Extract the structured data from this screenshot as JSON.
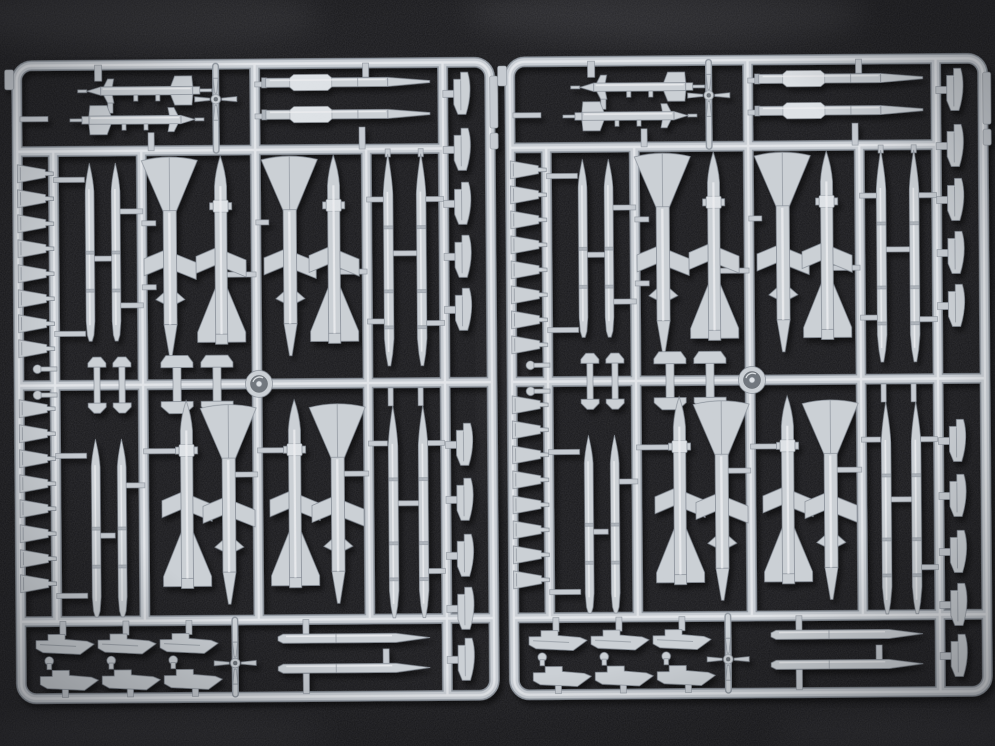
{
  "scene": {
    "description": "Photograph of two identical light-grey injection-moulded plastic model sprues holding air-to-air missile halves, missile bodies, pylons and fin parts, lying side by side on a dark charcoal fabric background",
    "objects": [
      {
        "label": "left parts sprue"
      },
      {
        "label": "right parts sprue, identical duplicate of the left one"
      }
    ],
    "surface": "dark woven fabric",
    "lighting": "soft light from upper left, parts cast small shadows down and right"
  },
  "colors": {
    "background": "#17171a",
    "fabric_highlight": "#8a8a90",
    "plastic_base": "#cbd0d5",
    "plastic_highlight": "#e9ecee",
    "plastic_shadow": "#8f969f",
    "part_outline": "#868d96",
    "ring_inner": "#70767d"
  },
  "sprue_contents_per_sprue": {
    "large_missile_halves_with_butterfly_fins": 8,
    "slim_missile_halves_vertical": 8,
    "canard_missiles_horizontal": 2,
    "missile_bodies_with_dorsal_fairing": 2,
    "slim_missile_bodies_horizontal": 2,
    "small_trapezoid_fins": 16,
    "edge_pylon_fins": 10,
    "underwing_pylons": 6,
    "launch_rail_sections_small": 2,
    "launch_rail_sections_large": 2,
    "cruciform_fin_units": 2,
    "ring_parts": 1,
    "pin_parts": 2,
    "total_parts": 63
  },
  "layout": {
    "sprues": 2,
    "grid": "outer rounded frame with three horizontal and five vertical runners"
  }
}
